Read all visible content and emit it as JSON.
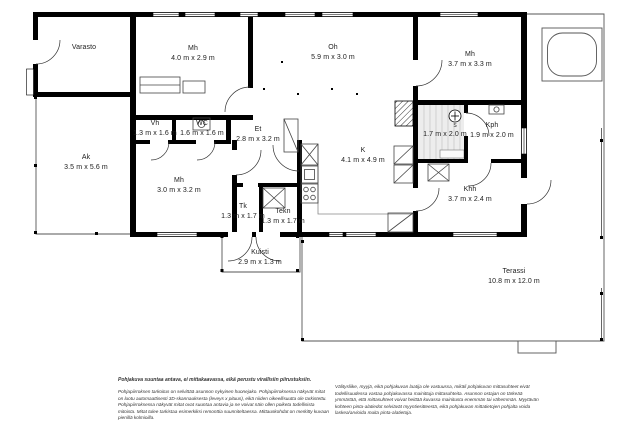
{
  "colors": {
    "wall": "#000000",
    "thin_line": "#555555",
    "background": "#ffffff"
  },
  "plan": {
    "rooms": {
      "varasto": {
        "name": "Varasto",
        "dims": ""
      },
      "mh_nw": {
        "name": "Mh",
        "dims": "4.0 m x 2.9 m"
      },
      "oh": {
        "name": "Oh",
        "dims": "5.9 m x 3.0 m"
      },
      "mh_ne": {
        "name": "Mh",
        "dims": "3.7 m x 3.3 m"
      },
      "ak": {
        "name": "Ak",
        "dims": "3.5 m x 5.6 m"
      },
      "vh": {
        "name": "Vh",
        "dims": "1.3 m x 1.6 m"
      },
      "wc": {
        "name": "WC",
        "dims": "1.6 m x 1.6 m"
      },
      "et": {
        "name": "Et",
        "dims": "2.8 m x 3.2 m"
      },
      "mh_sw": {
        "name": "Mh",
        "dims": "3.0 m x 3.2 m"
      },
      "k": {
        "name": "K",
        "dims": "4.1 m x 4.9 m"
      },
      "tk": {
        "name": "Tk",
        "dims": "1.3 m x 1.7 m"
      },
      "tekn": {
        "name": "Tekn",
        "dims": "1.3 m x 1.7 m"
      },
      "sauna": {
        "name": "",
        "dims": "1.7 m x 2.0 m"
      },
      "kph": {
        "name": "Kph",
        "dims": "1.9 m x 2.0 m"
      },
      "khh": {
        "name": "Khh",
        "dims": "3.7 m x 2.4 m"
      },
      "kuisti": {
        "name": "Kuisti",
        "dims": "2.9 m x 1.3 m"
      },
      "terassi": {
        "name": "Terassi",
        "dims": "10.8 m x 12.0 m"
      }
    },
    "sauna_stove_label": "S"
  },
  "disclaimer": {
    "heading": "Pohjakuva suuntaa antava, ei mittakaavassa, eikä perustu virallisiin piirustuksiin.",
    "left_body": "Pohjapiirroksen tarkoitus on selvittää asunnon nykyinen huonejako. Pohjapiirroksessa näkyvät mitat on luotu automaattisesti 3D-skannauksesta (leveys x pituus), eikä niiden oikeellisuutta ole tarkistettu. Pohjapiirroksessa näkyvät mitat ovat suuntaa antavia ja ne voivat näin ollen poiketa todellisista mitoista. Mitat tulee tarkistaa esimerkiksi remonttia suunniteltaessa. Mittauskohdat on merkitty kuvaan pienillä kolmioilla.",
    "right_body": "Välitysliike, myyjä, eikä pohjakuvan laatija ole vastuussa, mikäli pohjakuvan mittasuhteet eivät todellisuudessa vastaa pohjakuvassa mainittuja mittasuhteita. Asunnon ostajan on tärkeää ymmärtää, että mittasuhteet voivat heittää kuvassa mainitusta enemmän tai vähemmän. Myytävän kohteen pinta-alatiedot selviävät myyntiesitteestä, eikä pohjakuvan mittatietojen pohjalta voida laskea/arvioida muita pinta-alatietoja."
  }
}
